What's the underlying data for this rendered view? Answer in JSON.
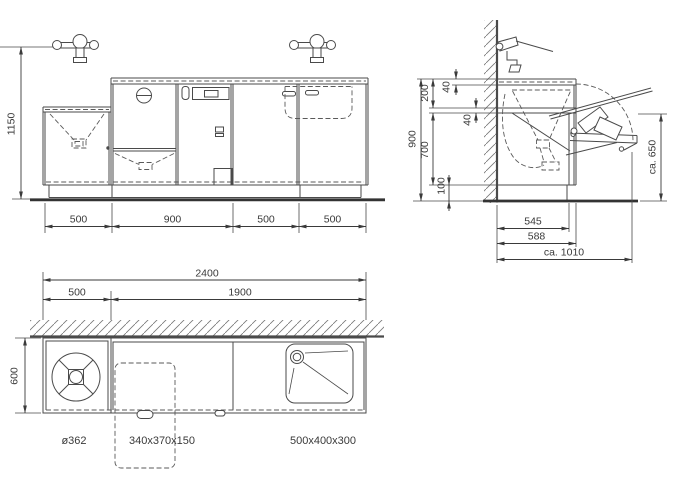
{
  "front": {
    "height": "1150",
    "w1": "500",
    "w2": "900",
    "w3": "500",
    "w4": "500"
  },
  "side": {
    "rail1": "40",
    "upstand": "200",
    "rail2": "40",
    "height": "900",
    "inner": "700",
    "plinth": "100",
    "fold": "ca. 650",
    "d1": "545",
    "d2": "588",
    "d3": "ca. 1010"
  },
  "plan": {
    "total": "2400",
    "left": "500",
    "rest": "1900",
    "depth": "600",
    "bowl": "ø362",
    "tipper": "340x370x150",
    "basin": "500x400x300"
  }
}
